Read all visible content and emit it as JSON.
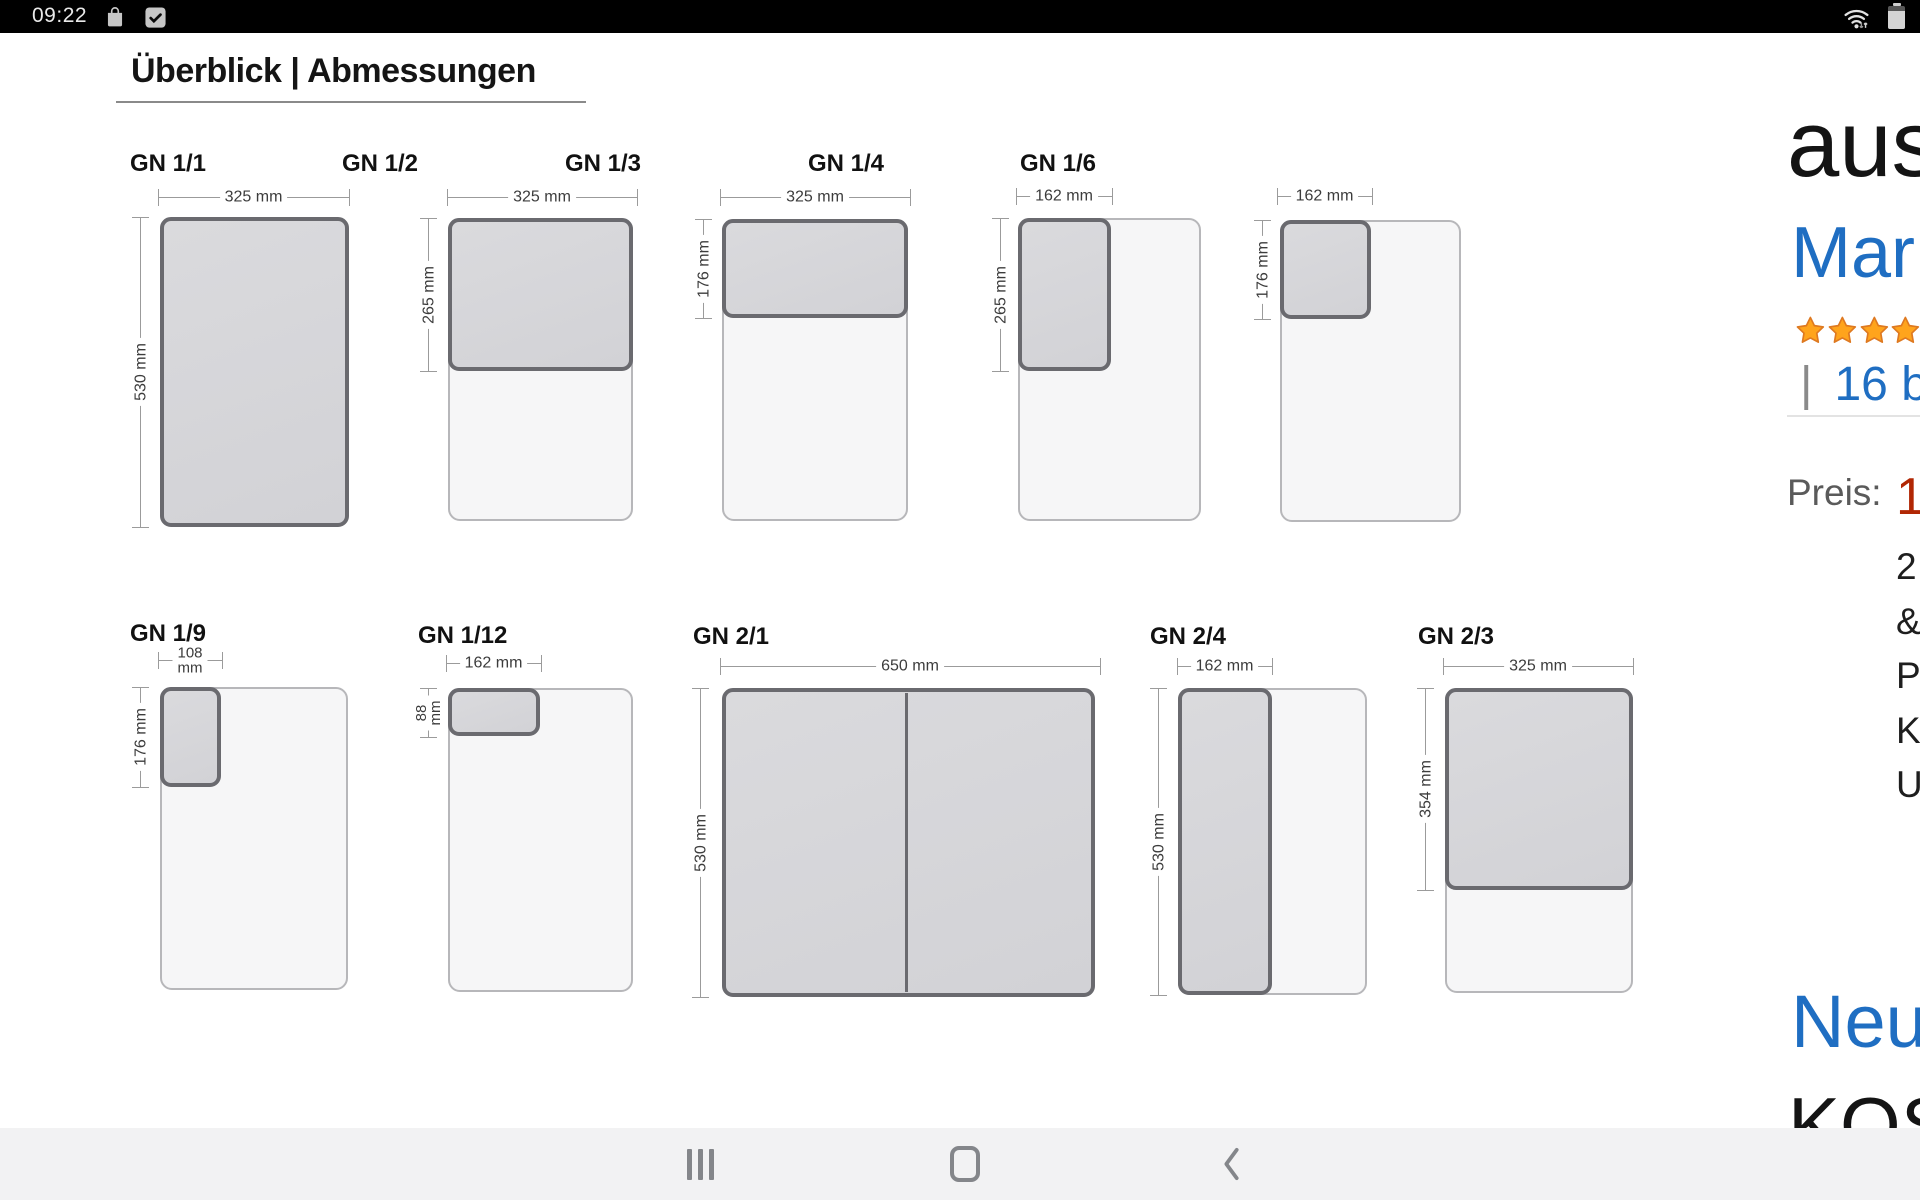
{
  "status_bar": {
    "time": "09:22",
    "left_icons": [
      "shopping-bag",
      "checkbox"
    ],
    "right_icons": [
      "wifi",
      "battery"
    ]
  },
  "section": {
    "title": "Überblick | Abmessungen"
  },
  "diagrams": [
    {
      "label": "GN 1/1",
      "width": "325 mm",
      "height": "530 mm"
    },
    {
      "label": "GN 1/2",
      "width": "325 mm",
      "height": "265 mm"
    },
    {
      "label": "GN 1/3",
      "width": "325 mm",
      "height": "176 mm"
    },
    {
      "label": "GN 1/4",
      "width": "162 mm",
      "height": "265 mm"
    },
    {
      "label": "GN 1/6",
      "width": "162 mm",
      "height": "176 mm"
    },
    {
      "label": "GN 1/9",
      "width": "108 mm",
      "height": "176 mm"
    },
    {
      "label": "GN 1/12",
      "width": "162 mm",
      "height": "88 mm"
    },
    {
      "label": "GN 2/1",
      "width": "650 mm",
      "height": "530 mm"
    },
    {
      "label": "GN 2/4",
      "width": "162 mm",
      "height": "530 mm"
    },
    {
      "label": "GN 2/3",
      "width": "325 mm",
      "height": "354 mm"
    }
  ],
  "product": {
    "title_fragment": "aus",
    "brand_fragment": "Mar",
    "stars_visible": 3,
    "reviews_separator": "|",
    "reviews_fragment": "16 be",
    "price_label": "Preis:",
    "price_fragment": "1",
    "bullets": [
      "2",
      "&",
      "P",
      "K",
      "U"
    ],
    "new_offers_fragment": "Neu",
    "shipping_fragment": "KOS"
  },
  "nav_bar": {
    "buttons": [
      "recents",
      "home",
      "back"
    ]
  },
  "colors": {
    "highlight_fill": "#d6d6d9",
    "highlight_border": "#6a6a6f",
    "outline_fill": "#f6f6f7",
    "outline_border": "#b7b7ba",
    "link_blue": "#1f6ec2",
    "price_red": "#b12704",
    "star_gold": "#FFA41C",
    "star_edge": "#DE7921",
    "nav_bg": "#f2f2f3",
    "nav_icon": "#84868a"
  }
}
